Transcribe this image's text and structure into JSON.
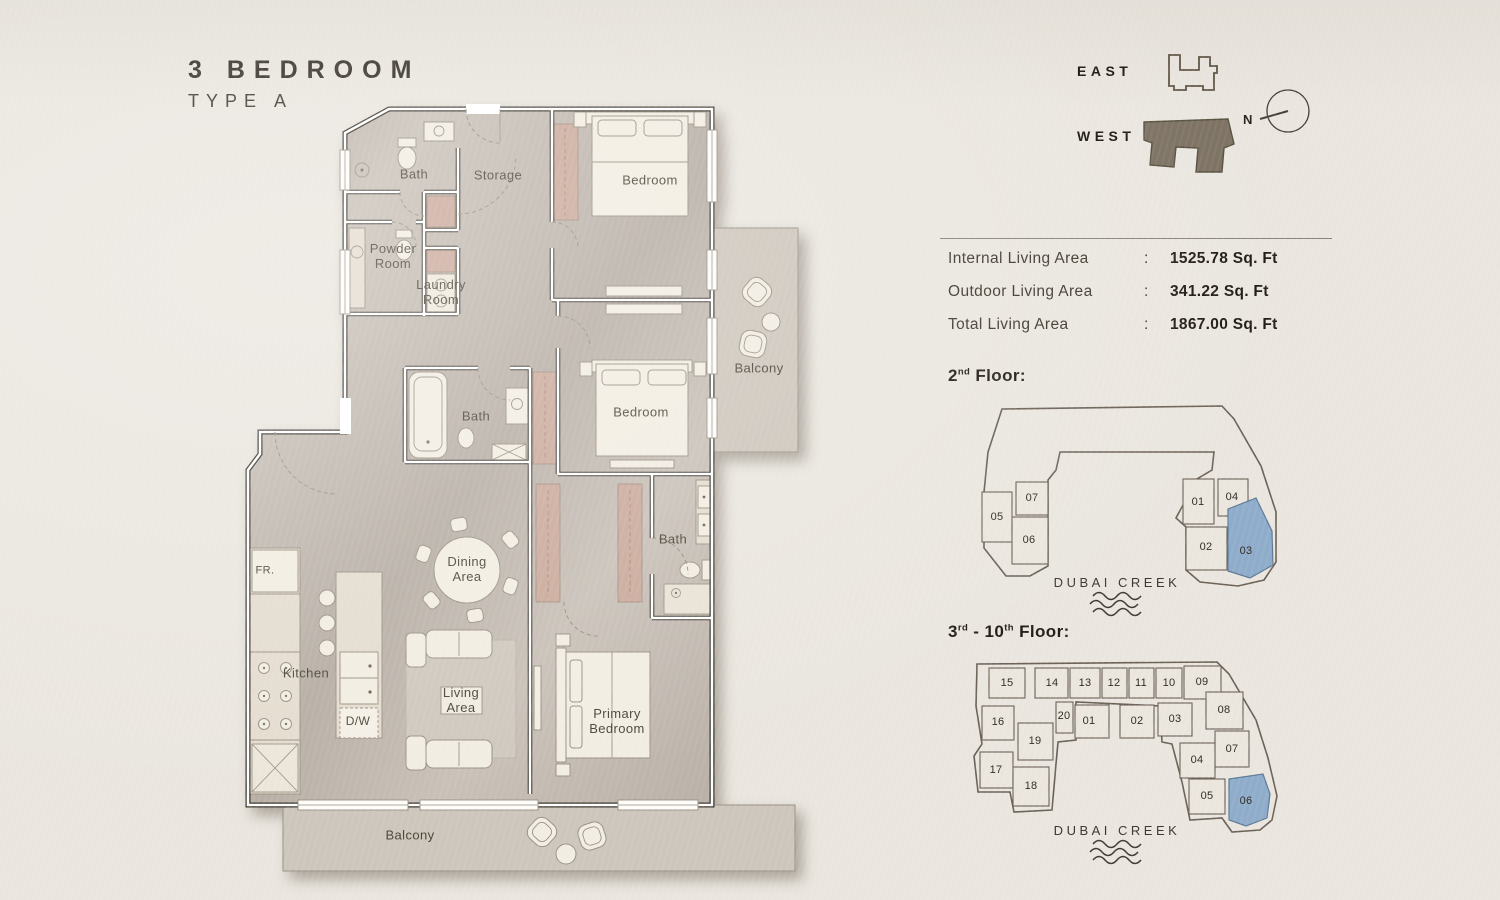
{
  "title": {
    "line1": "3 BEDROOM",
    "line2": "TYPE A"
  },
  "legend": {
    "east": "EAST",
    "west": "WEST",
    "compass_n": "N"
  },
  "stats": {
    "rows": [
      {
        "label": "Internal Living Area",
        "sep": ":",
        "value": "1525.78 Sq. Ft"
      },
      {
        "label": "Outdoor Living Area",
        "sep": ":",
        "value": "341.22 Sq. Ft"
      },
      {
        "label": "Total Living Area",
        "sep": ":",
        "value": "1867.00 Sq. Ft"
      }
    ]
  },
  "floor2": {
    "num": "2",
    "sup": "nd",
    "rest": " Floor:",
    "creek": "DUBAI CREEK",
    "units": [
      {
        "id": "05",
        "label": "05",
        "x": 997,
        "y": 517,
        "highlighted": false
      },
      {
        "id": "07",
        "label": "07",
        "x": 1032,
        "y": 498,
        "highlighted": false
      },
      {
        "id": "06",
        "label": "06",
        "x": 1029,
        "y": 540,
        "highlighted": false
      },
      {
        "id": "01",
        "label": "01",
        "x": 1198,
        "y": 502,
        "highlighted": false
      },
      {
        "id": "04",
        "label": "04",
        "x": 1232,
        "y": 497,
        "highlighted": false
      },
      {
        "id": "02",
        "label": "02",
        "x": 1206,
        "y": 547,
        "highlighted": false
      },
      {
        "id": "03",
        "label": "03",
        "x": 1246,
        "y": 551,
        "highlighted": true
      }
    ]
  },
  "floors3to10": {
    "num1": "3",
    "sup1": "rd",
    "mid": " - ",
    "num2": "10",
    "sup2": "th",
    "rest": " Floor:",
    "creek": "DUBAI CREEK",
    "units": [
      {
        "id": "15",
        "label": "15",
        "x": 1007,
        "y": 683,
        "highlighted": false
      },
      {
        "id": "14",
        "label": "14",
        "x": 1052,
        "y": 683,
        "highlighted": false
      },
      {
        "id": "13",
        "label": "13",
        "x": 1085,
        "y": 683,
        "highlighted": false
      },
      {
        "id": "12",
        "label": "12",
        "x": 1114,
        "y": 683,
        "highlighted": false
      },
      {
        "id": "11",
        "label": "11",
        "x": 1141,
        "y": 683,
        "highlighted": false
      },
      {
        "id": "10",
        "label": "10",
        "x": 1169,
        "y": 683,
        "highlighted": false
      },
      {
        "id": "09",
        "label": "09",
        "x": 1202,
        "y": 682,
        "highlighted": false
      },
      {
        "id": "16",
        "label": "16",
        "x": 998,
        "y": 722,
        "highlighted": false
      },
      {
        "id": "20",
        "label": "20",
        "x": 1064,
        "y": 716,
        "highlighted": false
      },
      {
        "id": "01",
        "label": "01",
        "x": 1089,
        "y": 721,
        "highlighted": false
      },
      {
        "id": "02",
        "label": "02",
        "x": 1137,
        "y": 721,
        "highlighted": false
      },
      {
        "id": "03",
        "label": "03",
        "x": 1175,
        "y": 719,
        "highlighted": false
      },
      {
        "id": "08",
        "label": "08",
        "x": 1224,
        "y": 710,
        "highlighted": false
      },
      {
        "id": "19",
        "label": "19",
        "x": 1035,
        "y": 741,
        "highlighted": false
      },
      {
        "id": "07",
        "label": "07",
        "x": 1232,
        "y": 749,
        "highlighted": false
      },
      {
        "id": "04",
        "label": "04",
        "x": 1197,
        "y": 760,
        "highlighted": false
      },
      {
        "id": "17",
        "label": "17",
        "x": 996,
        "y": 770,
        "highlighted": false
      },
      {
        "id": "18",
        "label": "18",
        "x": 1031,
        "y": 786,
        "highlighted": false
      },
      {
        "id": "05",
        "label": "05",
        "x": 1207,
        "y": 796,
        "highlighted": false
      },
      {
        "id": "06",
        "label": "06",
        "x": 1246,
        "y": 801,
        "highlighted": true
      }
    ]
  },
  "floorplan": {
    "rooms": [
      {
        "id": "bath-1",
        "label": "Bath",
        "x": 414,
        "y": 175
      },
      {
        "id": "storage",
        "label": "Storage",
        "x": 498,
        "y": 176
      },
      {
        "id": "bedroom-1",
        "label": "Bedroom",
        "x": 650,
        "y": 181
      },
      {
        "id": "powder-room",
        "label": "Powder\nRoom",
        "x": 393,
        "y": 257
      },
      {
        "id": "laundry-room",
        "label": "Laundry\nRoom",
        "x": 441,
        "y": 293
      },
      {
        "id": "bath-2",
        "label": "Bath",
        "x": 476,
        "y": 417
      },
      {
        "id": "bedroom-2",
        "label": "Bedroom",
        "x": 641,
        "y": 413
      },
      {
        "id": "balcony-right",
        "label": "Balcony",
        "x": 759,
        "y": 369
      },
      {
        "id": "bath-3",
        "label": "Bath",
        "x": 673,
        "y": 540
      },
      {
        "id": "dining-area",
        "label": "Dining\nArea",
        "x": 467,
        "y": 570
      },
      {
        "id": "kitchen",
        "label": "Kitchen",
        "x": 306,
        "y": 674
      },
      {
        "id": "living-area",
        "label": "Living\nArea",
        "x": 461,
        "y": 701
      },
      {
        "id": "primary-bedroom",
        "label": "Primary\nBedroom",
        "x": 617,
        "y": 722
      },
      {
        "id": "balcony-bottom",
        "label": "Balcony",
        "x": 410,
        "y": 836
      },
      {
        "id": "fridge",
        "label": "FR.",
        "x": 265,
        "y": 571,
        "size": 11
      },
      {
        "id": "dishwasher",
        "label": "D/W",
        "x": 358,
        "y": 722,
        "size": 12
      }
    ]
  },
  "colors": {
    "background": "#eae6df",
    "floor": "#c9c1b8",
    "wall_line": "#3a352d",
    "accent_wardrobe": "#cbaa9c",
    "unit_highlight": "#8fadcb",
    "diagram_line": "#6b6156",
    "text_dark": "#221d15"
  }
}
